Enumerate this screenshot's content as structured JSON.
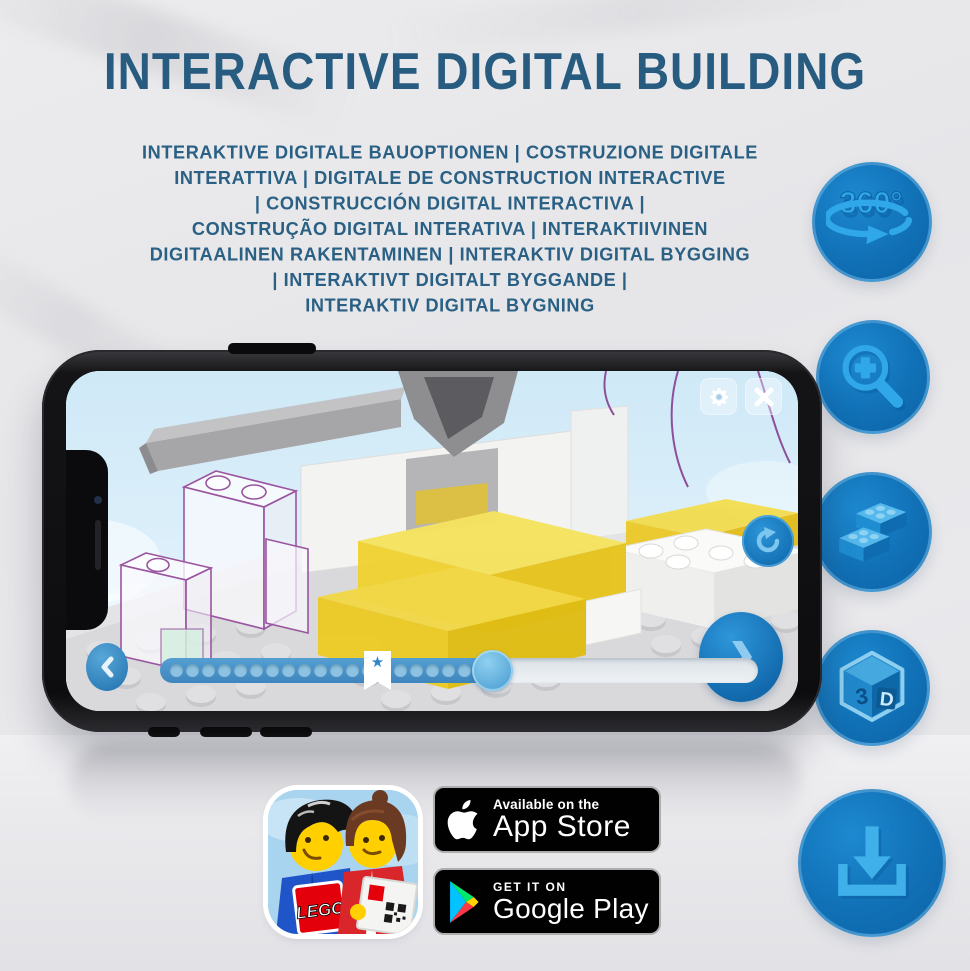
{
  "title": "INTERACTIVE DIGITAL BUILDING",
  "subtitle_lines": [
    "INTERAKTIVE DIGITALE BAUOPTIONEN | COSTRUZIONE DIGITALE",
    "INTERATTIVA | DIGITALE DE CONSTRUCTION INTERACTIVE",
    "| CONSTRUCCIÓN DIGITAL INTERACTIVA |",
    "CONSTRUÇÃO DIGITAL INTERATIVA | INTERAKTIIVINEN",
    "DIGITAALINEN RAKENTAMINEN | INTERAKTIV DIGITAL BYGGING",
    "| INTERAKTIVT DIGITALT BYGGANDE |",
    "INTERAKTIV DIGITAL BYGNING"
  ],
  "features": {
    "circle_color": "#1171b7",
    "icon_color": "#2fa7e8",
    "items": [
      {
        "icon": "rotate-360-icon",
        "label": "360°"
      },
      {
        "icon": "zoom-in-icon"
      },
      {
        "icon": "lego-bricks-icon"
      },
      {
        "icon": "cube-3d-icon",
        "label_left": "3",
        "label_right": "D"
      },
      {
        "icon": "download-icon"
      }
    ]
  },
  "phone": {
    "screen": {
      "top_buttons": [
        "settings-gear",
        "close"
      ],
      "rotate_button": "rotate-model",
      "star_marker": "★",
      "slider": {
        "dots_total": 19,
        "progress_fraction": 0.52
      }
    }
  },
  "app_icon": {
    "lego_logo_text": "LEGO"
  },
  "badges": {
    "app_store": {
      "line1": "Available on the",
      "line2": "App Store"
    },
    "google_play": {
      "line1": "GET IT ON",
      "line2": "Google Play"
    }
  },
  "colors": {
    "heading_blue": "#275c80",
    "feature_blue": "#1171b7",
    "badge_bg": "#010101"
  }
}
